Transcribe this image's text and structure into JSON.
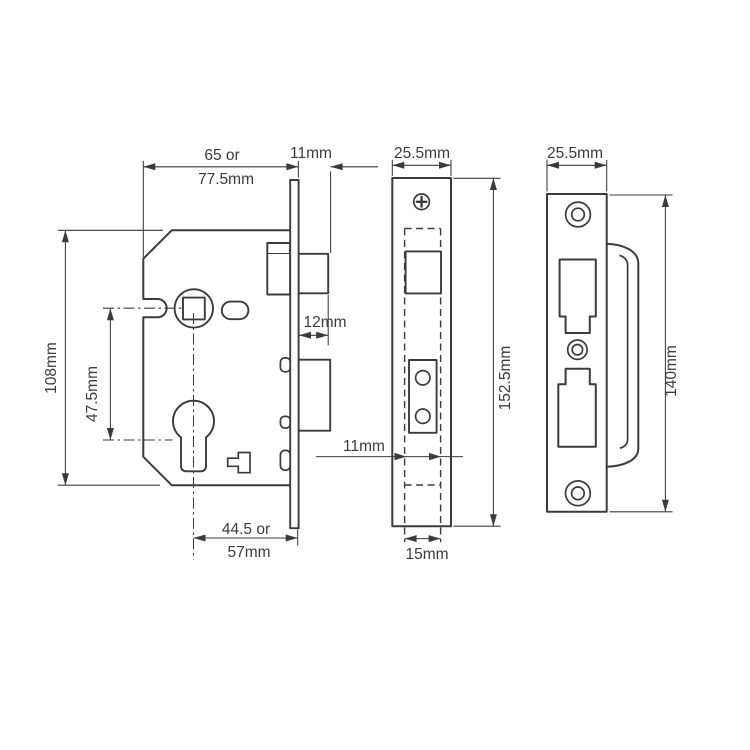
{
  "drawing": {
    "colors": {
      "line": "#3b3b3b",
      "background": "#ffffff"
    },
    "lock_case_side": {
      "dim_case_depth_line1": "65 or",
      "dim_case_depth_line2": "77.5mm",
      "dim_faceplate_clearance": "11mm",
      "dim_latch_projection": "12mm",
      "dim_case_height": "108mm",
      "dim_centres": "47.5mm",
      "dim_backset_line1": "44.5 or",
      "dim_backset_line2": "57mm"
    },
    "faceplate_front": {
      "dim_width": "25.5mm",
      "dim_height": "152.5mm",
      "dim_bolt_width": "11mm",
      "dim_case_width": "15mm"
    },
    "strike_plate": {
      "dim_width": "25.5mm",
      "dim_height": "140mm"
    }
  }
}
